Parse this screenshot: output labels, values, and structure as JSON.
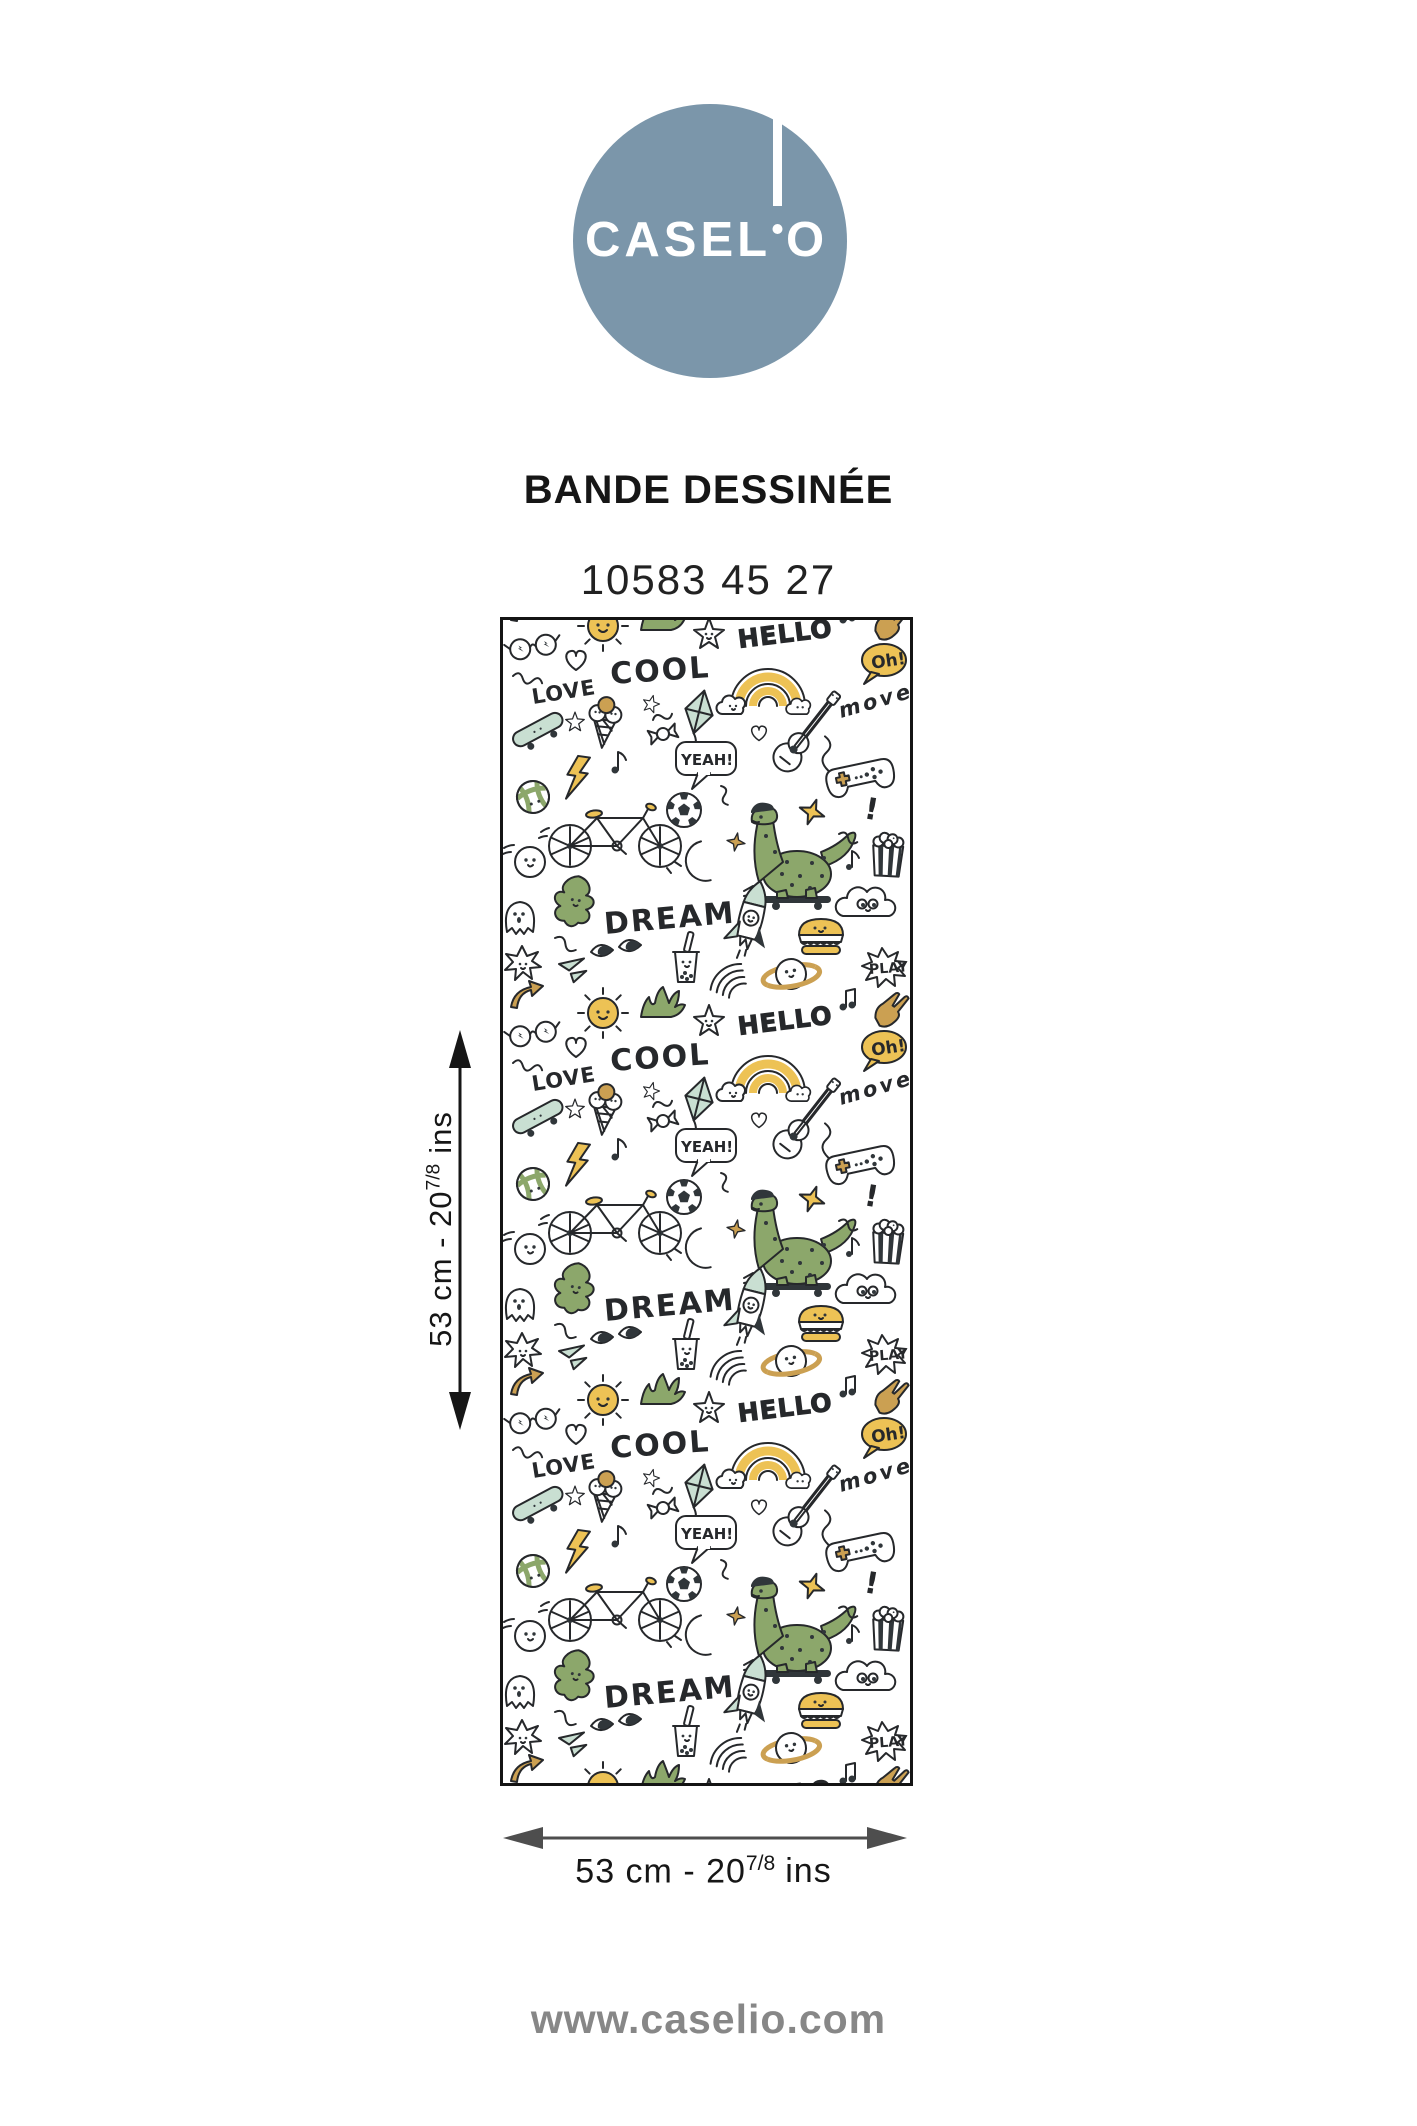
{
  "logo": {
    "wordmark_left": "CASEL",
    "wordmark_right": "O",
    "brand": "CASELIO",
    "circle_color": "#7B96AA"
  },
  "product": {
    "collection": "BANDE DESSINÉE",
    "reference": "10583 45 27"
  },
  "swatch": {
    "pattern_words": {
      "hello": "HELLO",
      "cool": "COOL",
      "love": "LOVE",
      "yeah": "YEAH!",
      "dream": "DREAM",
      "move": "move",
      "oh": "Oh!",
      "play": "PLAY"
    },
    "palette": {
      "green": "#8CA76B",
      "mint": "#C9DFD2",
      "yellow": "#EDC255",
      "tan": "#CBA052",
      "dark": "#30363A",
      "outline": "#26282B"
    }
  },
  "dimensions": {
    "height": {
      "prefix": "53 cm - 20",
      "sup": "7/8",
      "suffix": "ins"
    },
    "width": {
      "prefix": "53 cm - 20",
      "sup": "7/8",
      "suffix": "ins"
    }
  },
  "footer": {
    "website": "www.caselio.com"
  },
  "colors": {
    "vertical_arrow": "#161616",
    "horizontal_arrow": "#4E4E4E",
    "swatch_border": "#141414",
    "footer_gray": "#878787"
  }
}
